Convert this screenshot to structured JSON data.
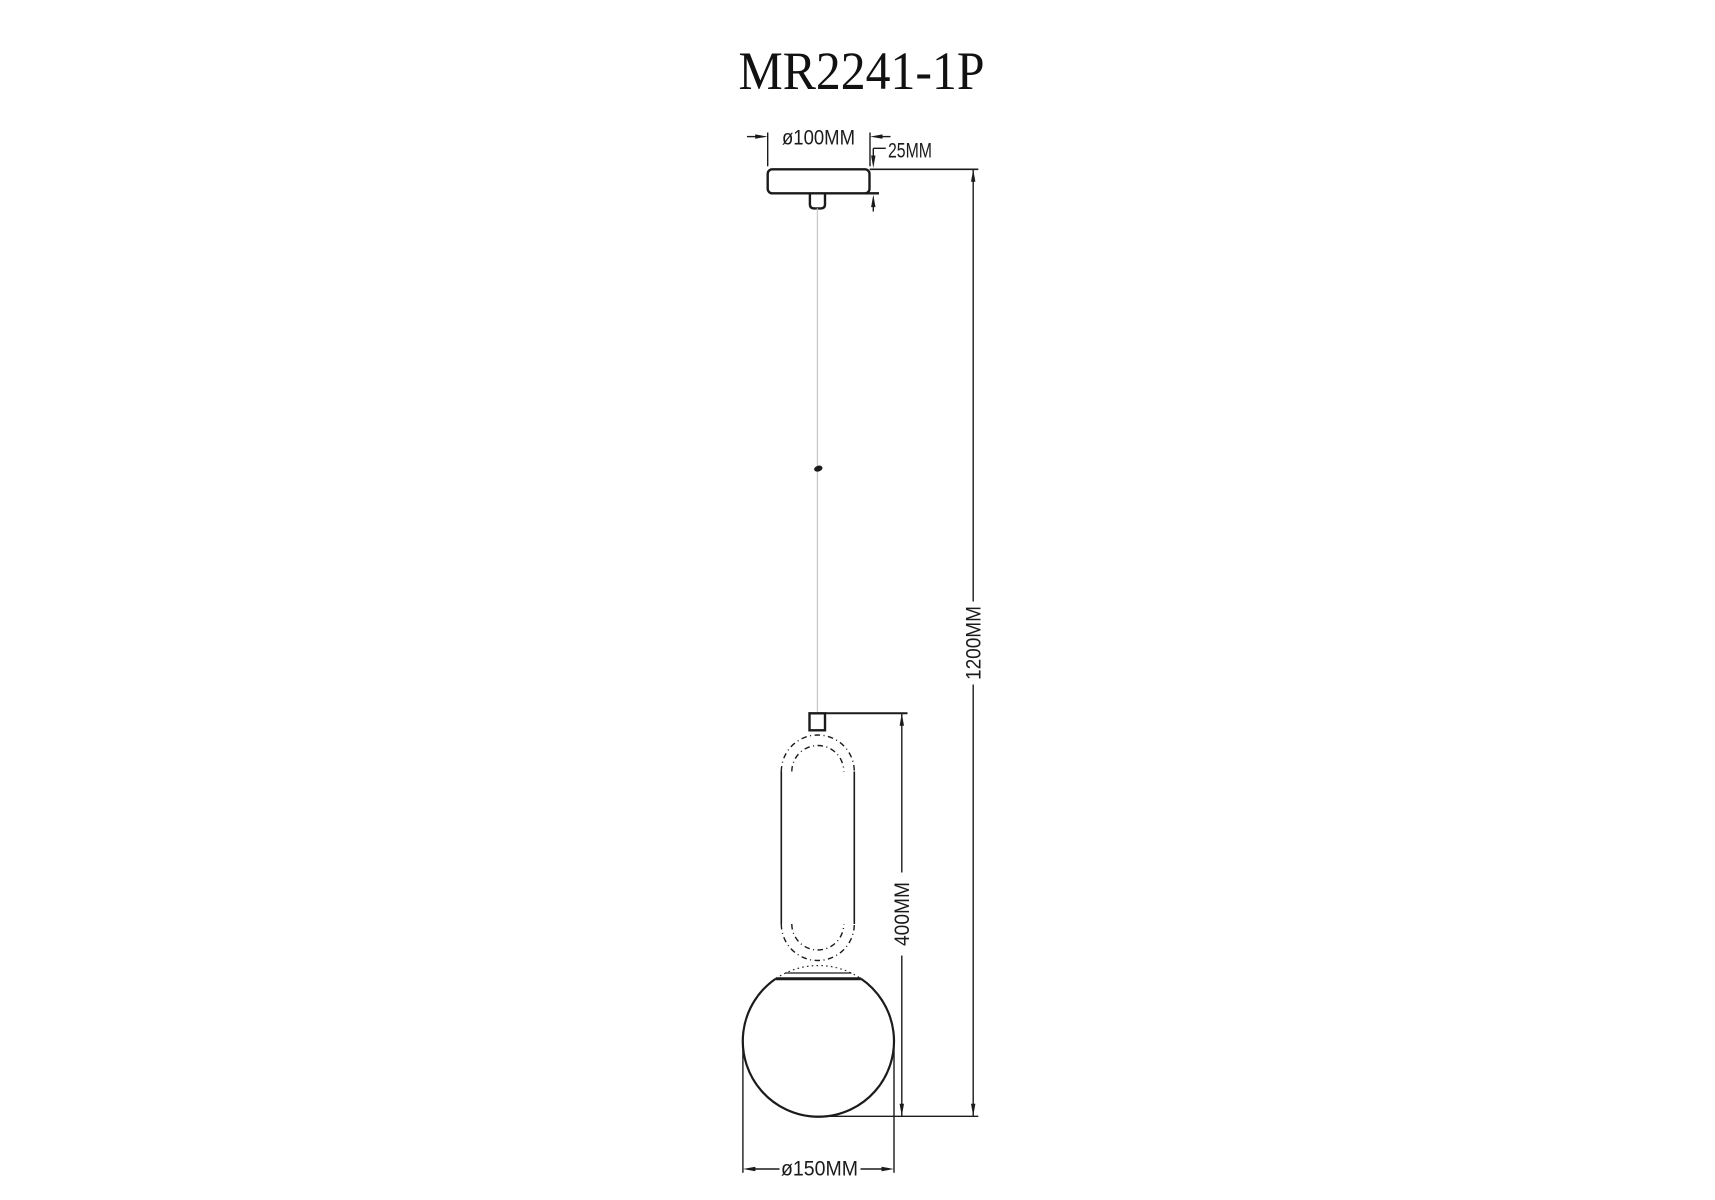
{
  "title": "MR2241-1P",
  "dimensions": {
    "canopy_diameter": "ø100MM",
    "canopy_height": "25MM",
    "overall_drop": "1200MM",
    "pendant_body_height": "400MM",
    "sphere_diameter": "ø150MM"
  },
  "colors": {
    "line": "#1b1b1b",
    "cable": "#c9c9c9",
    "background": "#ffffff"
  }
}
